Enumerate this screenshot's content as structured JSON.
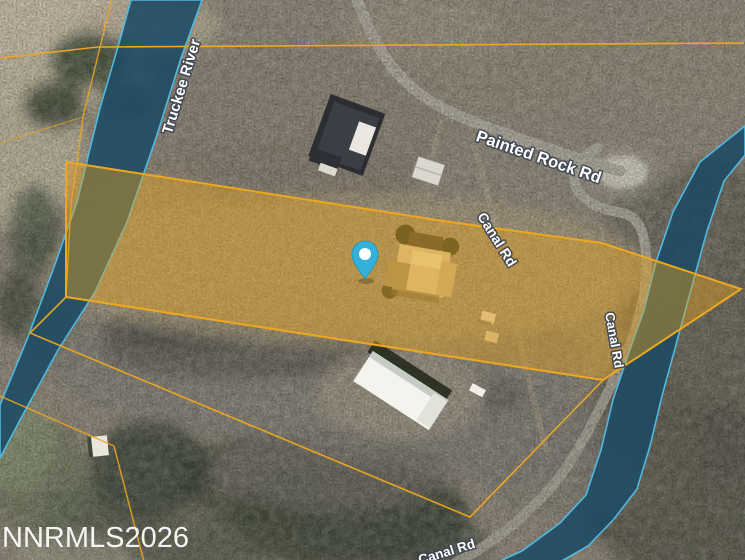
{
  "map_view": {
    "labels": {
      "river": "Truckee River",
      "painted_rock_road": "Painted Rock Rd",
      "canal_road_mid": "Canal Rd",
      "canal_road_right": "Canal Rd",
      "canal_road_bottom": "Canal Rd"
    },
    "watermark": "NNRMLS2026",
    "colors": {
      "parcel_line": "#EDA81F",
      "parcel_fill": "#E8A31A",
      "water_fill": "#1C4A63",
      "water_edge": "#52B8DE",
      "pin": "#35B1D9",
      "pin_inner": "#FFFFFF",
      "label_text": "#FFFFFF",
      "label_halo": "#3C4552"
    }
  }
}
